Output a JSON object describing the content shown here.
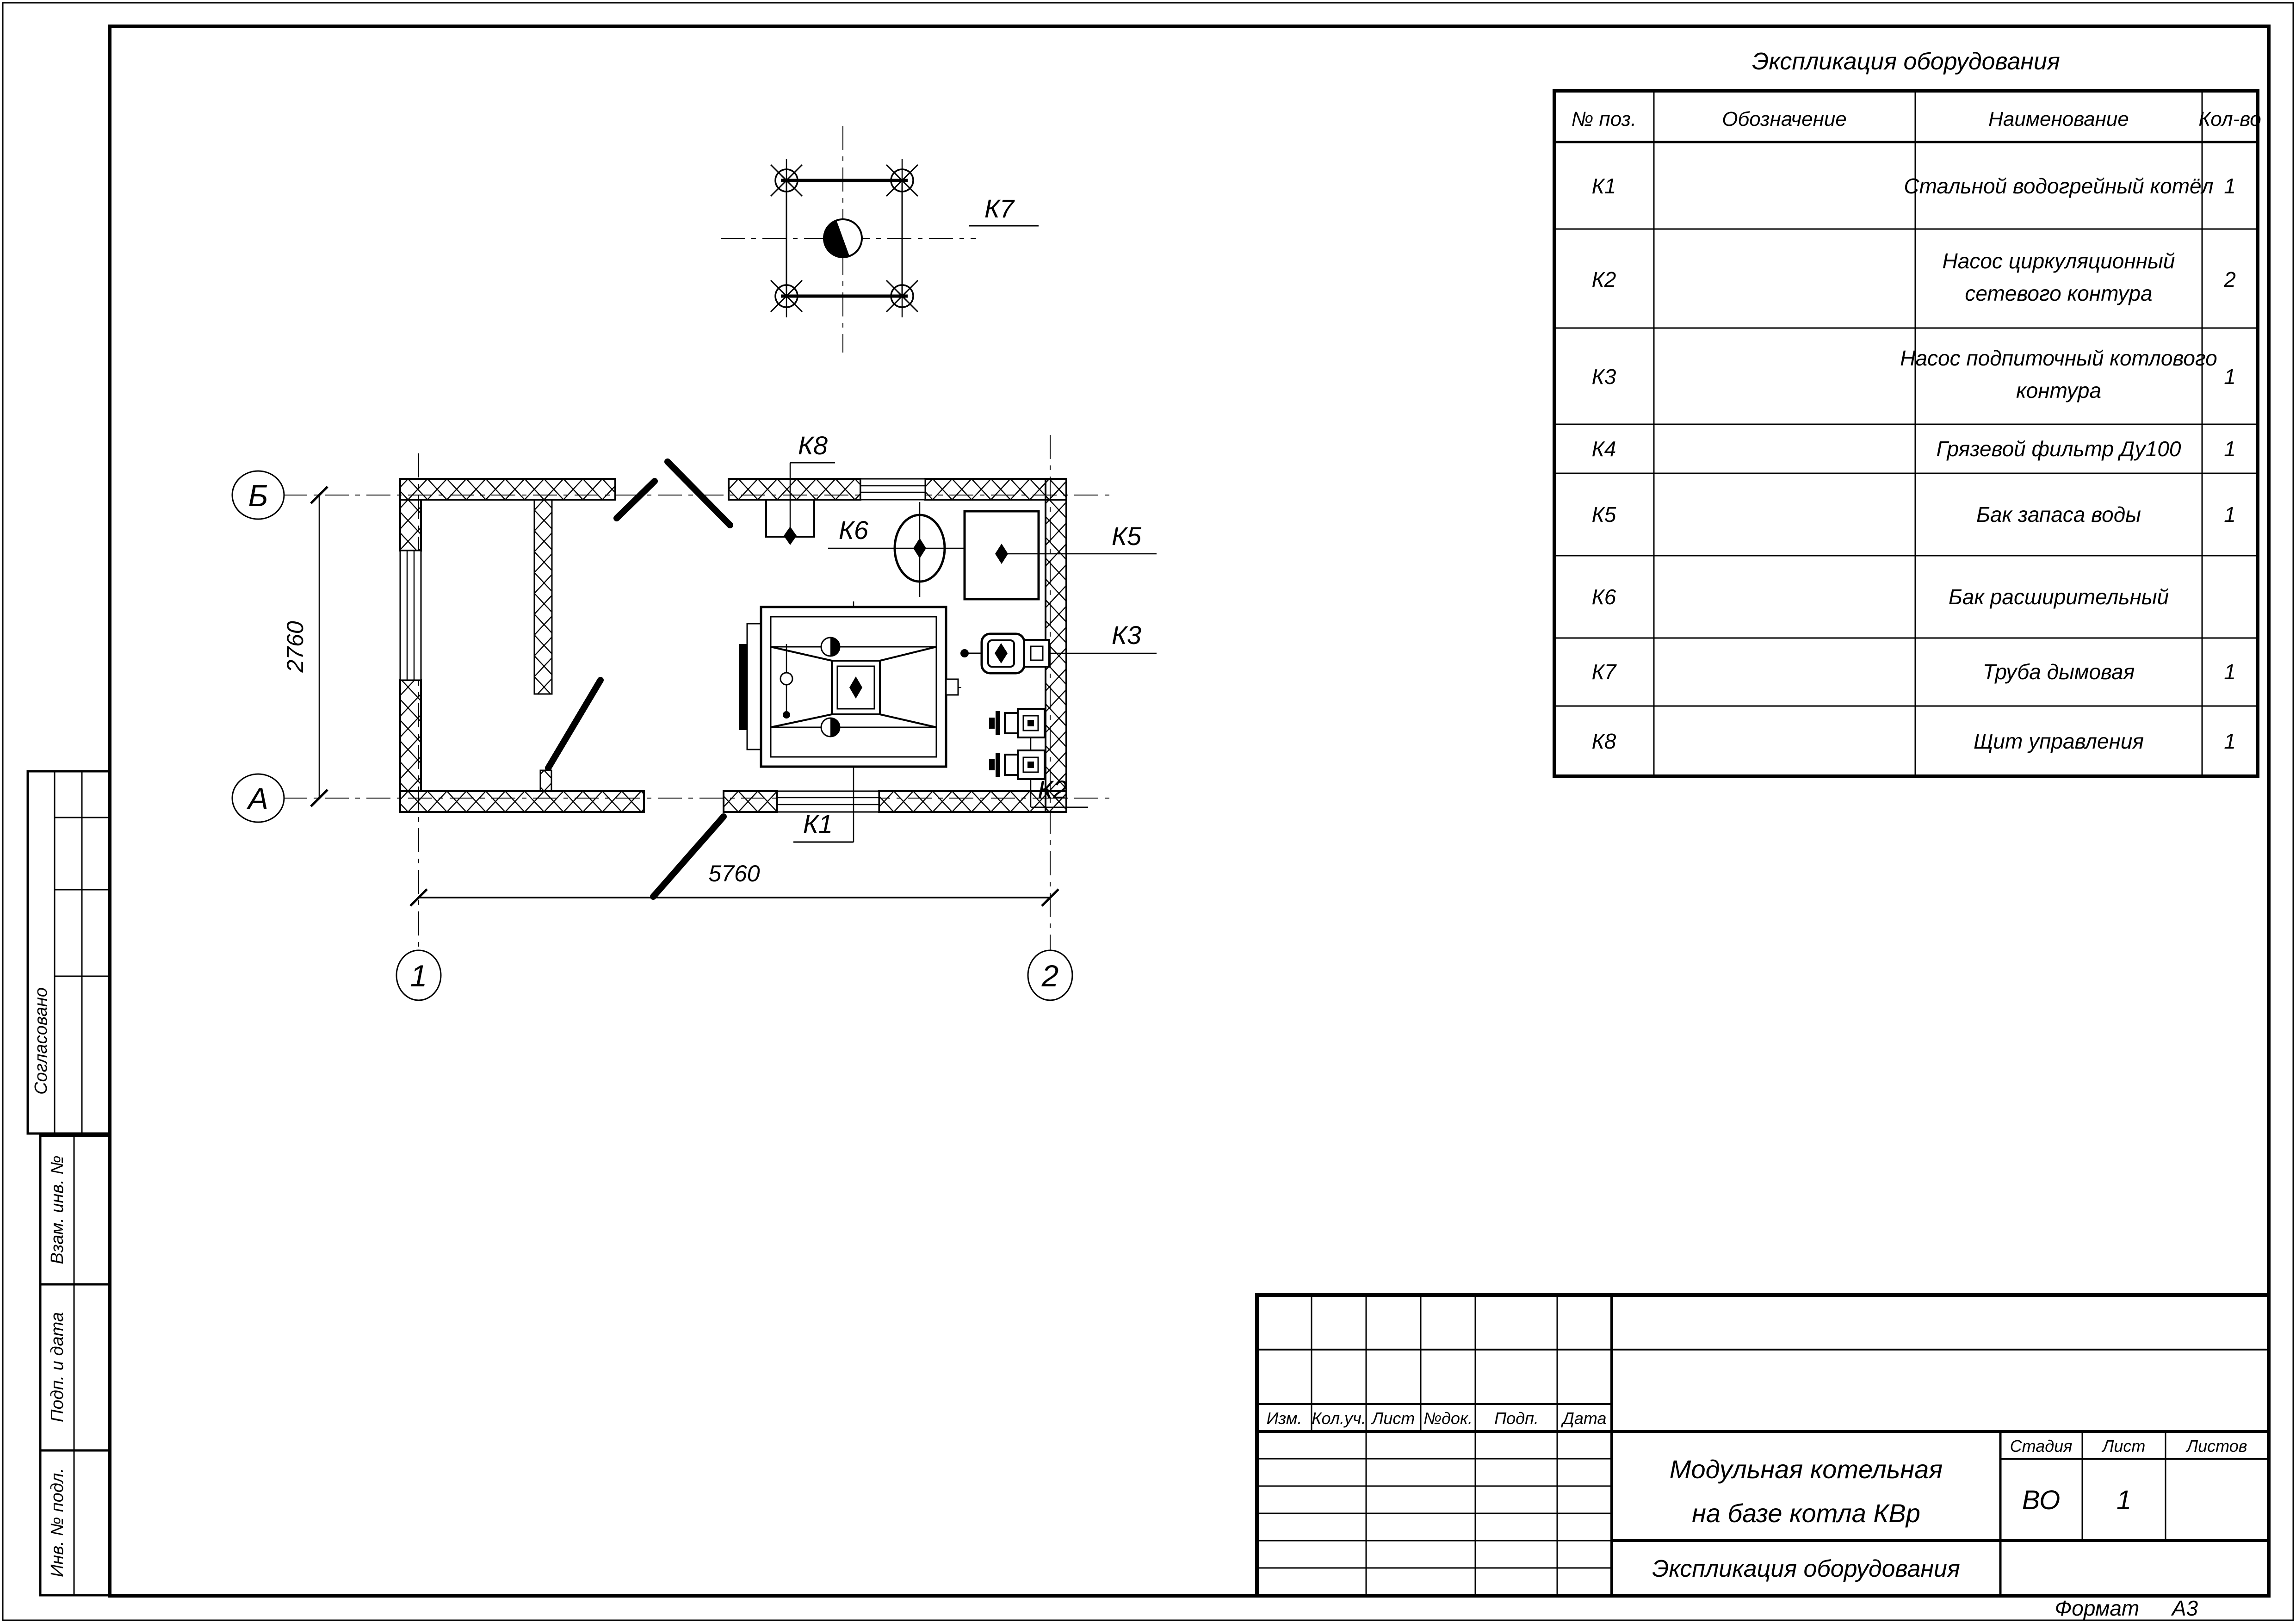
{
  "table": {
    "title": "Экспликация оборудования",
    "headers": [
      "№ поз.",
      "Обозначение",
      "Наименование",
      "Кол-во"
    ],
    "rows": [
      {
        "pos": "К1",
        "designation": "",
        "name": "Стальной водогрейный котёл",
        "name2": "",
        "qty": "1"
      },
      {
        "pos": "К2",
        "designation": "",
        "name": "Насос циркуляционный",
        "name2": "сетевого контура",
        "qty": "2"
      },
      {
        "pos": "К3",
        "designation": "",
        "name": "Насос подпиточный котлового",
        "name2": "контура",
        "qty": "1"
      },
      {
        "pos": "К4",
        "designation": "",
        "name": "Грязевой фильтр Ду100",
        "name2": "",
        "qty": "1"
      },
      {
        "pos": "К5",
        "designation": "",
        "name": "Бак запаса воды",
        "name2": "",
        "qty": "1"
      },
      {
        "pos": "К6",
        "designation": "",
        "name": "Бак расширительный",
        "name2": "",
        "qty": ""
      },
      {
        "pos": "К7",
        "designation": "",
        "name": "Труба дымовая",
        "name2": "",
        "qty": "1"
      },
      {
        "pos": "К8",
        "designation": "",
        "name": "Щит управления",
        "name2": "",
        "qty": "1"
      }
    ]
  },
  "plan": {
    "axis_b": "Б",
    "axis_a": "А",
    "axis_1": "1",
    "axis_2": "2",
    "dim_width": "5760",
    "dim_height": "2760",
    "eq_labels": {
      "k1": "К1",
      "k2": "К2",
      "k3": "К3",
      "k5": "К5",
      "k6": "К6",
      "k7": "К7",
      "k8": "К8"
    }
  },
  "title_block": {
    "change_cols": [
      "Изм.",
      "Кол.уч.",
      "Лист",
      "№док.",
      "Подп.",
      "Дата"
    ],
    "project_line1": "Модульная котельная",
    "project_line2": "на базе котла КВр",
    "doc_name": "Экспликация оборудования",
    "stage_label": "Стадия",
    "sheet_label": "Лист",
    "sheets_label": "Листов",
    "stage_value": "ВО",
    "sheet_value": "1",
    "sheets_value": ""
  },
  "sidebar": {
    "items": [
      "Согласовано",
      "Взам. инв. №",
      "Подп. и дата",
      "Инв. № подл."
    ]
  },
  "footer": {
    "format_label": "Формат",
    "format_value": "А3"
  }
}
